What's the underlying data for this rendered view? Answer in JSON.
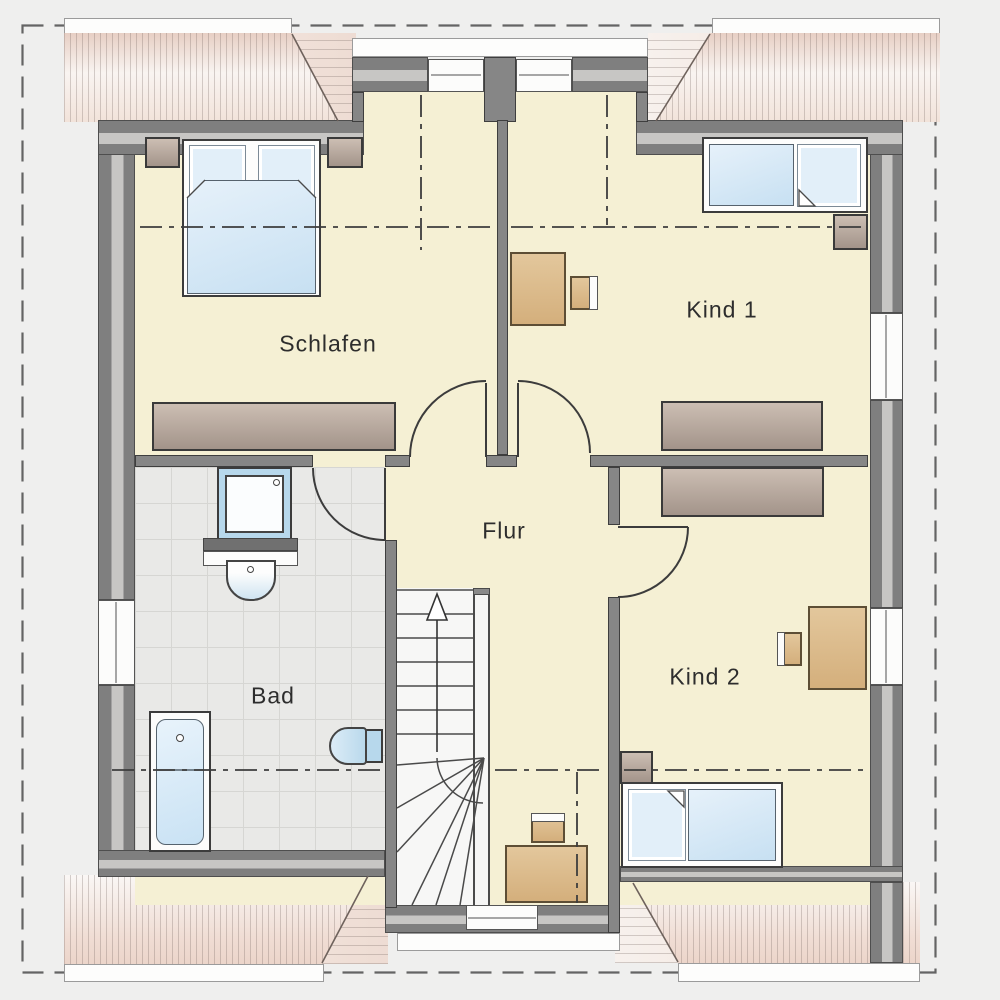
{
  "plan": {
    "kind": "floor-plan-upper-storey",
    "rooms": [
      {
        "id": "schlafen",
        "label": "Schlafen"
      },
      {
        "id": "kind-1",
        "label": "Kind 1"
      },
      {
        "id": "kind-2",
        "label": "Kind 2"
      },
      {
        "id": "bad",
        "label": "Bad"
      },
      {
        "id": "flur",
        "label": "Flur"
      }
    ],
    "colors": {
      "room_fill": "#f5f0d4",
      "wall": "#868686",
      "wall_insulation": "#c7c6c4",
      "tile_floor": "#e9e9e7",
      "furniture_wood": "#dcc096",
      "furniture_wardrobe": "#b5a79b",
      "bed_textile": "#cfe4f3",
      "roof_stripe_pink": "#e8d0c5",
      "outside": "#efefee",
      "line_dark": "#3c3c3c"
    }
  }
}
